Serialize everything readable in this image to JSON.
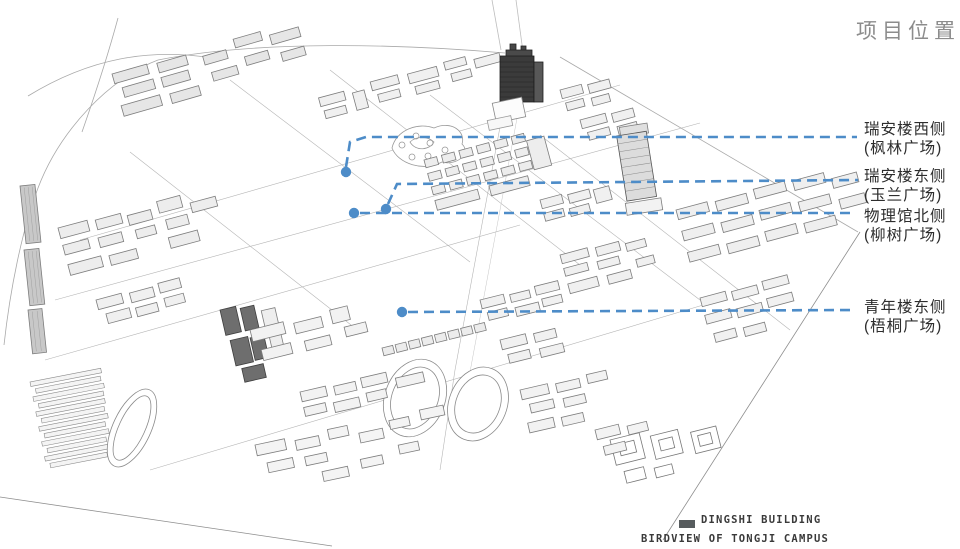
{
  "title": {
    "text": "项目位置"
  },
  "annotations": [
    {
      "name": "ruian-west",
      "line1": "瑞安楼西侧",
      "line2": "(枫林广场)",
      "label_x": 864,
      "label_y": 120,
      "dot": {
        "x": 346,
        "y": 172
      },
      "path": "346,167 350,142 366,137 857,137"
    },
    {
      "name": "ruian-east",
      "line1": "瑞安楼东侧",
      "line2": "(玉兰广场)",
      "label_x": 864,
      "label_y": 167,
      "dot": {
        "x": 386,
        "y": 209
      },
      "path": "388,204 397,184 858,180"
    },
    {
      "name": "physics-north",
      "line1": "物理馆北侧",
      "line2": "(柳树广场)",
      "label_x": 864,
      "label_y": 207,
      "dot": {
        "x": 354,
        "y": 213
      },
      "path": "360,213 852,213"
    },
    {
      "name": "youth-east",
      "line1": "青年楼东侧",
      "line2": "(梧桐广场)",
      "label_x": 864,
      "label_y": 298,
      "dot": {
        "x": 402,
        "y": 312
      },
      "path": "408,312 853,310"
    }
  ],
  "legend": {
    "swatch_color": "#575c5e",
    "swatch_label": "DINGSHI BUILDING",
    "caption": "BIRDVIEW OF TONGJI CAMPUS"
  },
  "colors": {
    "annotation": "#4d8cc8",
    "title": "#8c8c8c",
    "label_text": "#2d2d2d",
    "legend_text": "#3a3a3a"
  }
}
